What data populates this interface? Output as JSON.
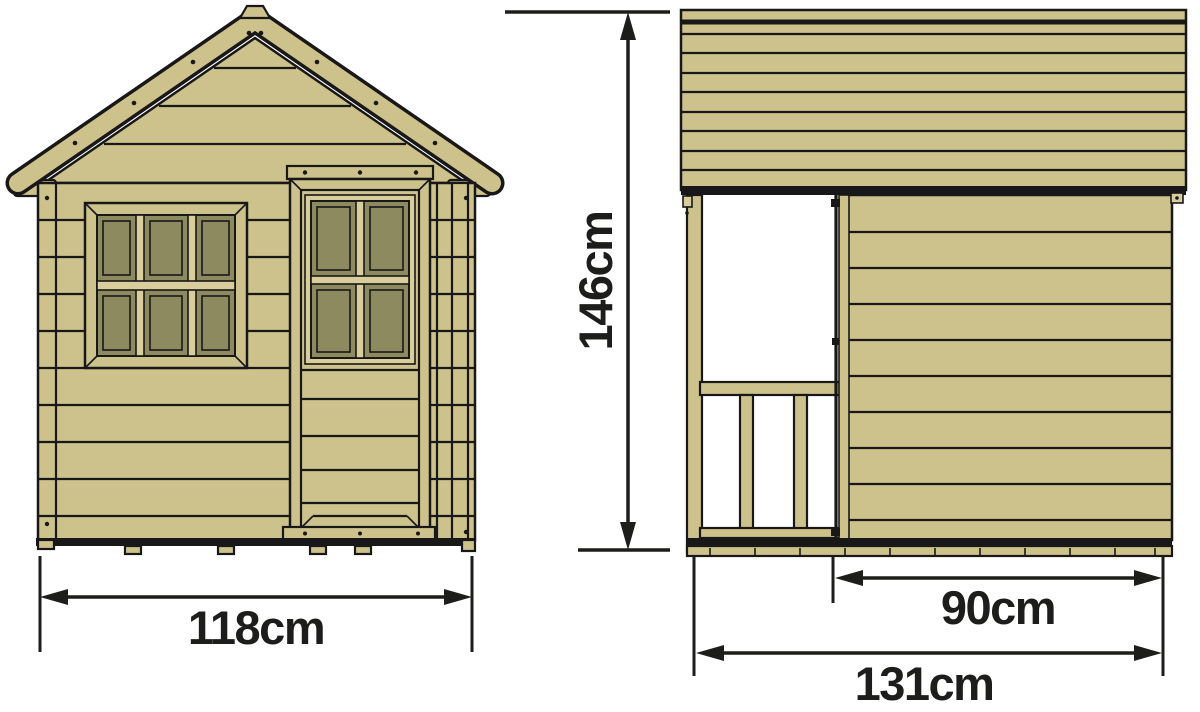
{
  "diagram": {
    "dimensions": {
      "front_width": "118cm",
      "height": "146cm",
      "side_partial_width": "90cm",
      "side_total_width": "131cm"
    },
    "dimension_values_cm": {
      "front_width": 118,
      "height": 146,
      "side_partial_width": 90,
      "side_total_width": 131
    }
  },
  "colors": {
    "wood": "#cec28c",
    "wood_light": "#d9cd9c",
    "glass": "#8d8a60",
    "outline": "#181818",
    "dim": "#1d1d1b",
    "bg": "#ffffff"
  }
}
